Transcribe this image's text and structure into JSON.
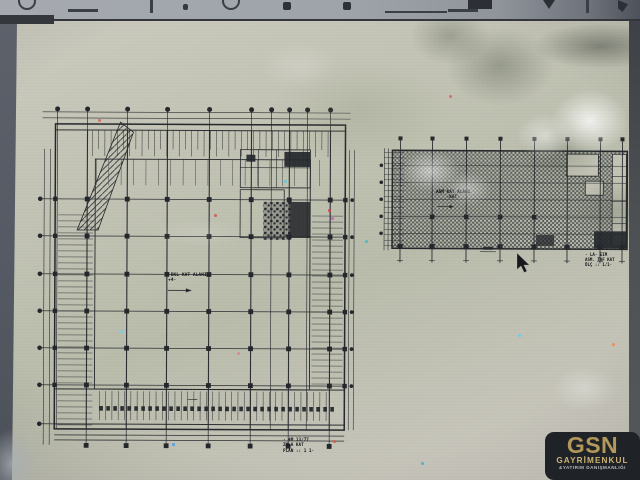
{
  "window": {
    "toolbar_icons": [
      {
        "name": "circle-icon",
        "type": "circle",
        "x": 18
      },
      {
        "name": "dash-icon",
        "type": "dash",
        "x": 68
      },
      {
        "name": "bar-icon",
        "type": "bar",
        "x": 150
      },
      {
        "name": "dot-icon",
        "type": "dot",
        "x": 183
      },
      {
        "name": "circle-icon",
        "type": "circle",
        "x": 222
      },
      {
        "name": "blob-icon",
        "type": "blob",
        "x": 283
      },
      {
        "name": "blob-icon",
        "type": "blob",
        "x": 343
      },
      {
        "name": "underline-icon",
        "type": "underline",
        "x": 385
      },
      {
        "name": "dash-icon",
        "type": "dash",
        "x": 448
      },
      {
        "name": "rect-icon",
        "type": "rect",
        "x": 468
      },
      {
        "name": "vee-icon",
        "type": "vee",
        "x": 543
      },
      {
        "name": "bar-icon",
        "type": "bar",
        "x": 586
      },
      {
        "name": "chevron-icon",
        "type": "chevron",
        "x": 618
      }
    ]
  },
  "left_plan": {
    "center_label": "·BKL KAT ALANI·",
    "center_note": "+4·",
    "title_lines": [
      "· 4M 13/77",
      "ZMLA  KAT",
      "PLAN :: 1 1·"
    ],
    "grid": {
      "cols": [
        57,
        87,
        127,
        167,
        209,
        251,
        271,
        289,
        307,
        330
      ],
      "main_cols": [
        87,
        127,
        167,
        209,
        251,
        289,
        330
      ],
      "rows": [
        200,
        237,
        275,
        312,
        349,
        386
      ]
    }
  },
  "right_plan": {
    "center_line1": "ASM KAT ALANI",
    "center_line2": "·KAT·",
    "title_lines": [
      "· LA· EIM",
      "ASM. TAF KAT",
      "ÖLÇ :: 1/1·"
    ],
    "grid": {
      "cols": [
        400,
        432,
        466,
        500,
        534,
        567,
        600,
        622
      ],
      "rows": [
        165,
        182,
        199,
        216,
        233
      ]
    }
  },
  "cursor": {
    "x": 517,
    "y": 232
  },
  "logo": {
    "brand": "GSN",
    "line2": "GAYRİMENKUL",
    "line3": "&YATIRIM DANIŞMANLIĞI",
    "colors": {
      "bg": "#1f2227",
      "gold": "#b2985a",
      "gold_light": "#ccb273",
      "grey": "#b9bcc0"
    }
  },
  "colors": {
    "paper": "#c2c3b4",
    "ink": "#24272b",
    "toolbar": "#9ea3aa",
    "bezel": "#555963"
  },
  "noise_specks": [
    {
      "x": 98,
      "y": 98,
      "c": "#d06a5a"
    },
    {
      "x": 328,
      "y": 188,
      "c": "#cc4444"
    },
    {
      "x": 284,
      "y": 159,
      "c": "#58c8d8"
    },
    {
      "x": 331,
      "y": 196,
      "c": "#cc55cc"
    },
    {
      "x": 214,
      "y": 193,
      "c": "#cc5555"
    },
    {
      "x": 172,
      "y": 422,
      "c": "#4499ee"
    },
    {
      "x": 421,
      "y": 441,
      "c": "#44aadd"
    },
    {
      "x": 333,
      "y": 419,
      "c": "#dd5544"
    },
    {
      "x": 612,
      "y": 322,
      "c": "#ee8855"
    },
    {
      "x": 518,
      "y": 313,
      "c": "#66ccee"
    },
    {
      "x": 449,
      "y": 74,
      "c": "#dd6666"
    },
    {
      "x": 365,
      "y": 219,
      "c": "#44bbcc"
    },
    {
      "x": 237,
      "y": 331,
      "c": "#dd8888"
    },
    {
      "x": 120,
      "y": 309,
      "c": "#77ccee"
    }
  ]
}
